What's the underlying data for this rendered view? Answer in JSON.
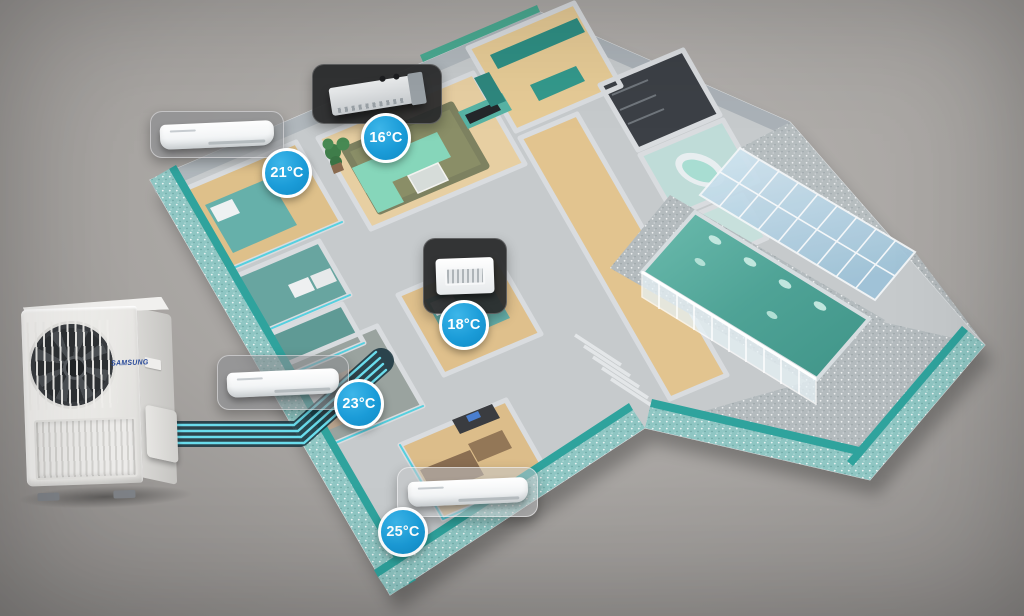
{
  "scene": {
    "subject": "3d-home-floorplan-with-multi-split-air-conditioning",
    "background_color": "#a5a2a0",
    "refrigerant_lines_count": 4
  },
  "outdoor_unit": {
    "brand_logo": "SAMSUNG",
    "type": "outdoor-condenser-unit"
  },
  "indoor_units": [
    {
      "room": "living-room",
      "style": "concealed-duct-unit",
      "temp": "16°C"
    },
    {
      "room": "bedroom-upper-left",
      "style": "wall-mounted-unit",
      "temp": "21°C"
    },
    {
      "room": "bedroom-center",
      "style": "ceiling-cassette-unit",
      "temp": "18°C"
    },
    {
      "room": "bedroom-lower-left",
      "style": "wall-mounted-unit",
      "temp": "23°C"
    },
    {
      "room": "study-room",
      "style": "wall-mounted-unit",
      "temp": "25°C"
    }
  ],
  "colors": {
    "badge_blue": "#1b9cd8",
    "pipe_cyan": "#6adcec",
    "teal_accent": "#2fa39d",
    "pool_water": "#4fae9e",
    "logo_blue": "#2a4b9b"
  }
}
